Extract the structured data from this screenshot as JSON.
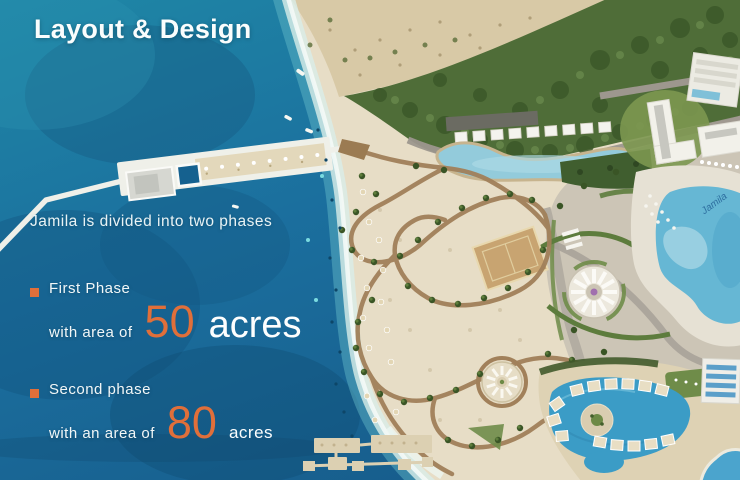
{
  "slide": {
    "title": "Layout & Design",
    "intro": "Jamila is divided into two phases",
    "phase1": {
      "label": "First Phase",
      "prefix": "with area of",
      "value": "50",
      "unit": "acres"
    },
    "phase2": {
      "label": "Second phase",
      "prefix": "with an area of",
      "value": "80",
      "unit": "acres"
    }
  },
  "map": {
    "pool_label": "Jamila"
  },
  "colors": {
    "accent": "#E06F3A",
    "ocean": "#1B6F9E",
    "sand": "#E7DDC6",
    "text": "#FFFFFF"
  }
}
